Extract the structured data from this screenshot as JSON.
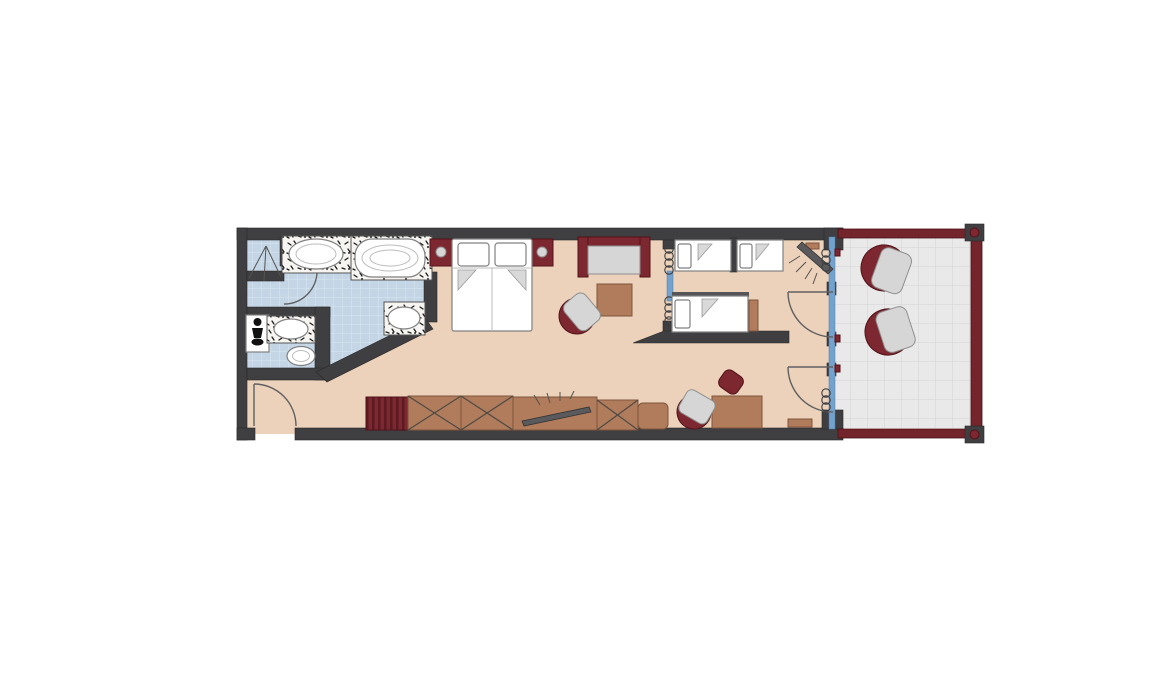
{
  "colors": {
    "wall": "#3f3f41",
    "wallStroke": "#28282a",
    "floor": "#ecd2ba",
    "tile": "#c4d6e6",
    "tileLine": "#d9e5f0",
    "maroon": "#7d2730",
    "maroonDark": "#521219",
    "brown": "#b17c5b",
    "brownDark": "#7d553c",
    "seat": "#d6d6d6",
    "seatStroke": "#8f8f8f",
    "fixtureStroke": "#808080",
    "glass": "#74a2ce",
    "rail": "#74242b",
    "tvGray": "#5a5a5c",
    "doorStroke": "#606062",
    "balconyFloor": "#e9e9ea",
    "balconyLine": "#d2d2d5",
    "marbleBase": "#f6f5f2"
  },
  "plan": {
    "type": "floor-plan",
    "rooms": [
      "bathroom",
      "wc",
      "bedroom-living-room",
      "kids-room",
      "balcony"
    ],
    "inventory": {
      "bathroom": [
        "shower",
        "vanity-basin",
        "bathtub",
        "second-basin"
      ],
      "wc": [
        "toilet",
        "wc-basin",
        "bidet"
      ],
      "bedroom_living": [
        "double-bed",
        "nightstand-left",
        "nightstand-right",
        "sofa",
        "coffee-table",
        "armchair",
        "minibar-cabinet",
        "wardrobe-1",
        "wardrobe-2",
        "tv-sideboard",
        "wardrobe-3",
        "sideboard-end",
        "desk",
        "desk-chair",
        "ottoman",
        "bench-cabinet"
      ],
      "kids_room": [
        "single-bed-1",
        "single-bed-2",
        "single-bed-3",
        "corner-tv"
      ],
      "balcony": [
        "lounge-chair-1",
        "lounge-chair-2",
        "railing"
      ],
      "doors": [
        "entry-door",
        "shower-door",
        "kids-balcony-door",
        "living-balcony-door"
      ],
      "glazing": [
        "balcony-glass-facade",
        "room-divider-glass"
      ],
      "curtains": 4
    }
  }
}
